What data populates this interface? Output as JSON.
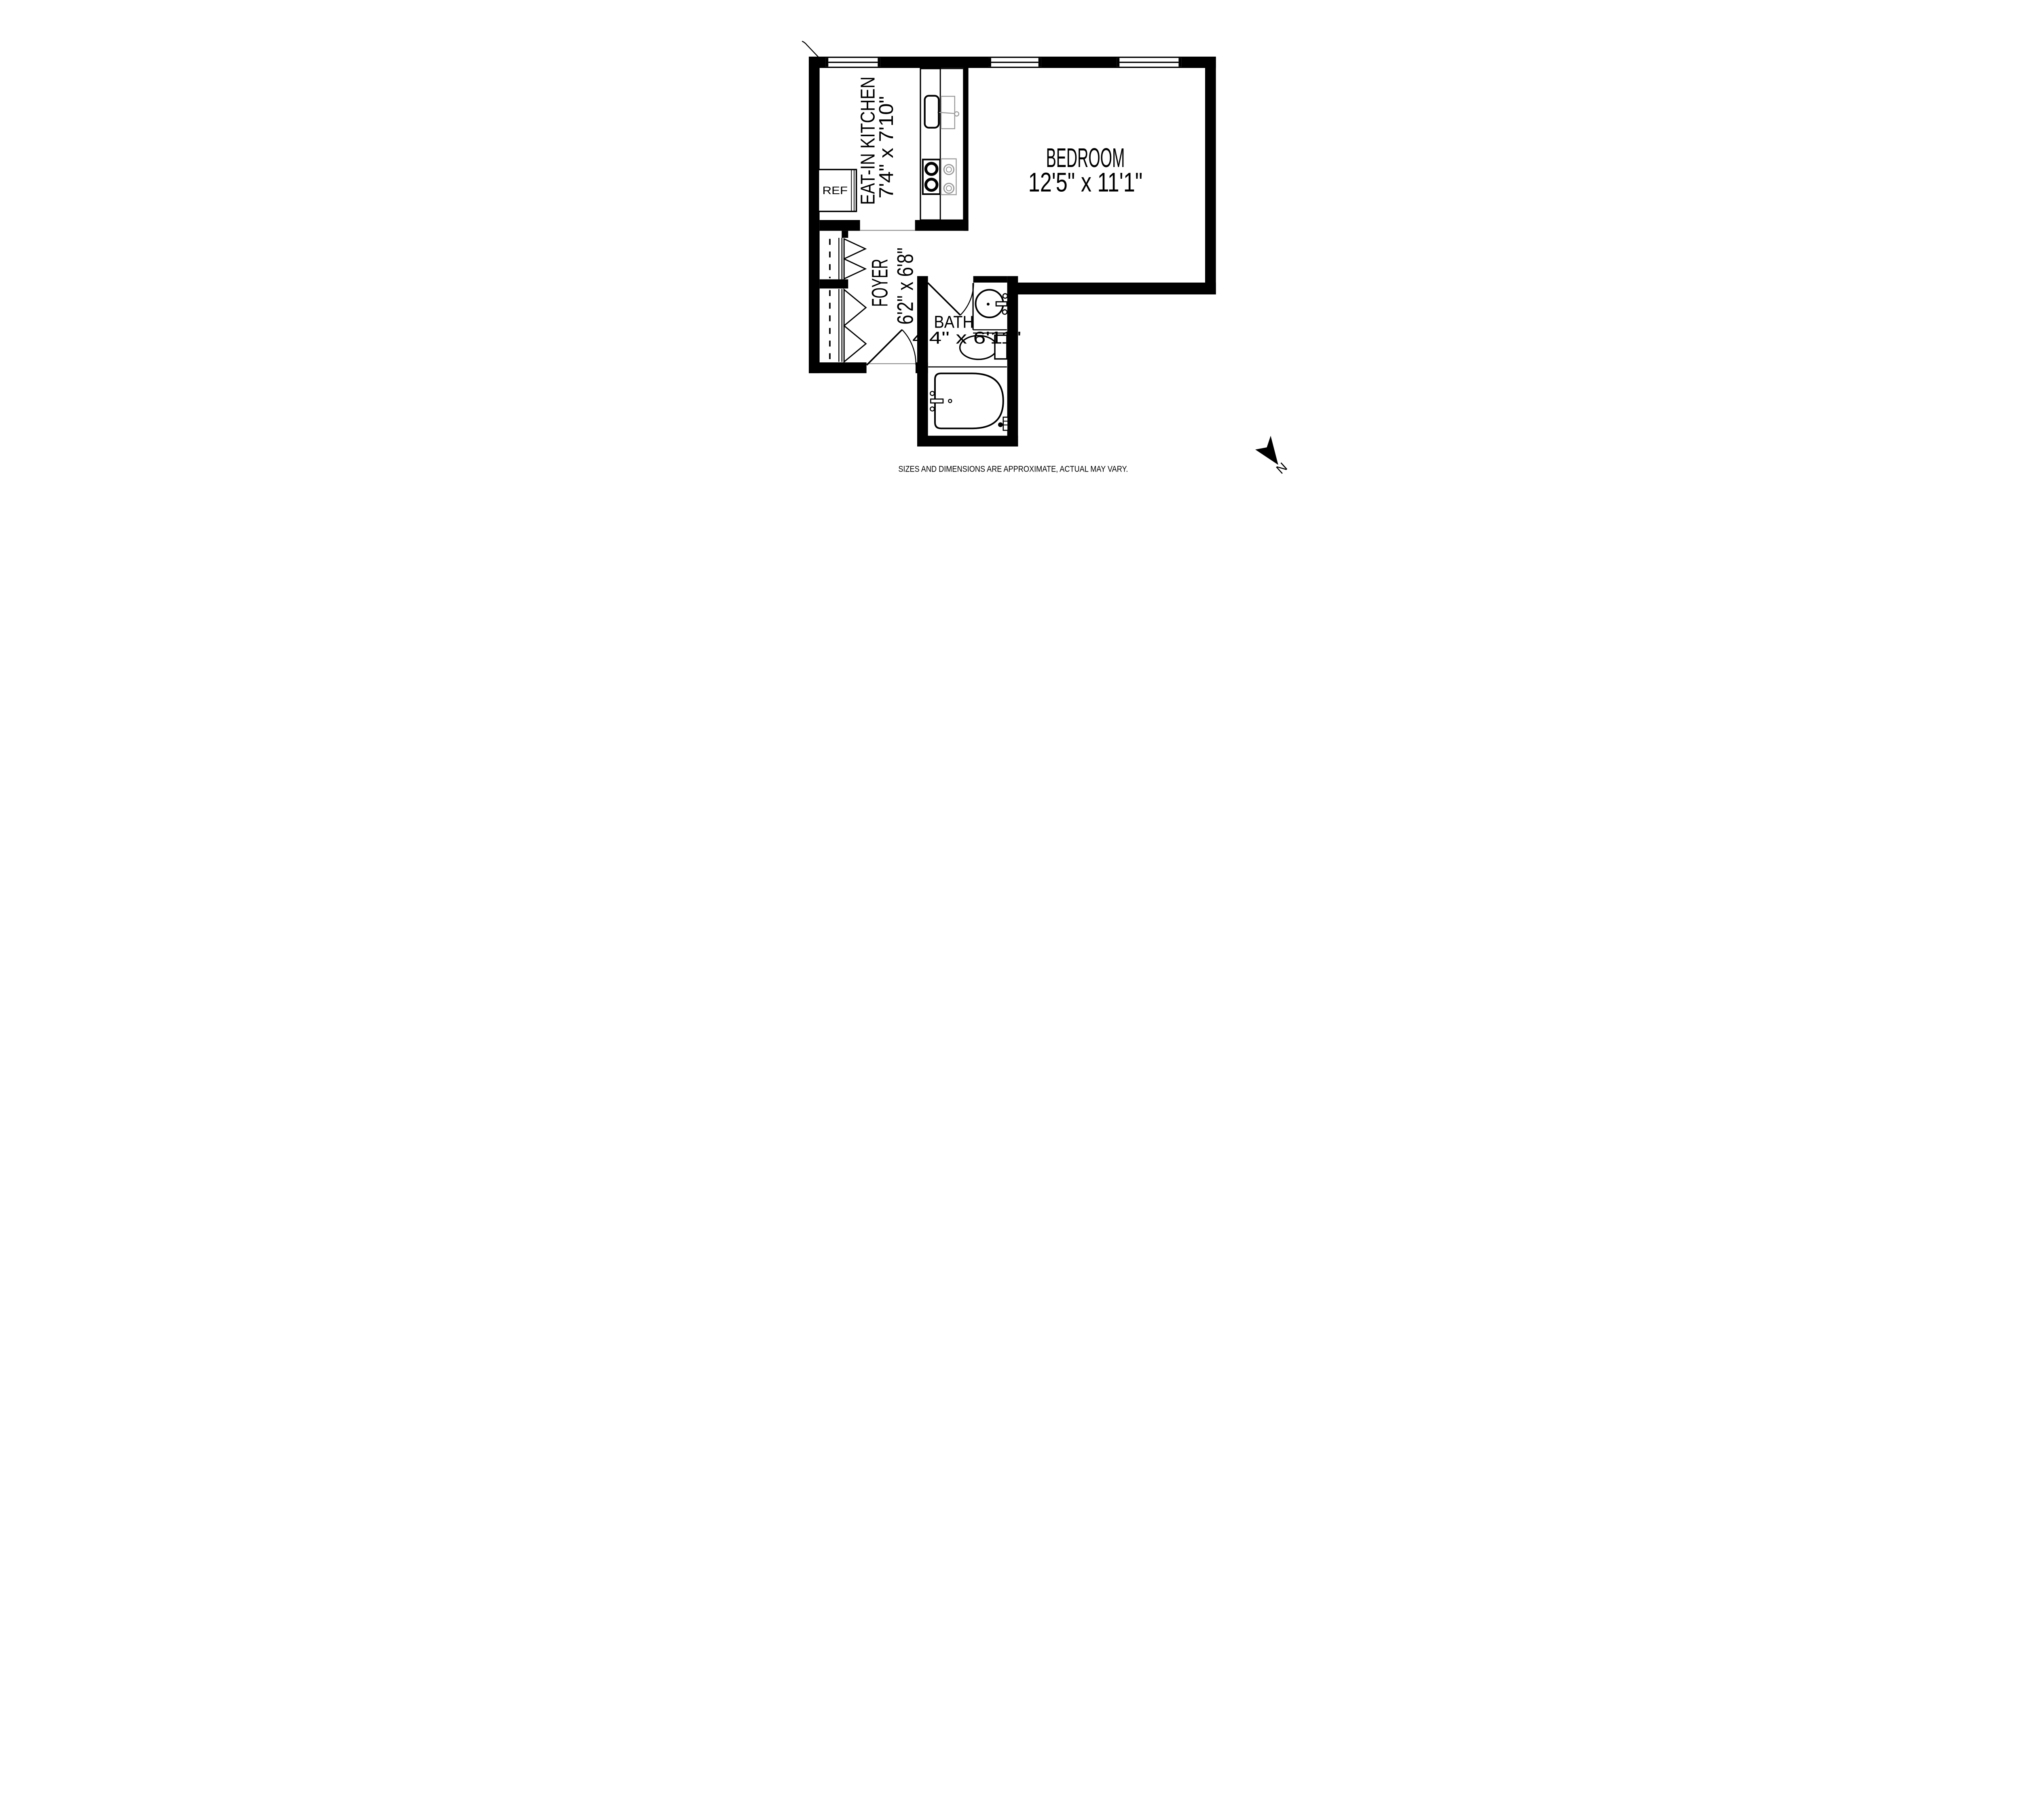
{
  "floorplan": {
    "rooms": [
      {
        "id": "kitchen",
        "name": "EAT-IN KITCHEN",
        "dimensions": "7'4\" x 7'10\""
      },
      {
        "id": "bedroom",
        "name": "BEDROOM",
        "dimensions": "12'5\" x 11'1\""
      },
      {
        "id": "foyer",
        "name": "FOYER",
        "dimensions": "6'2\" x 6'8\""
      },
      {
        "id": "bath",
        "name": "BATH",
        "dimensions": "4'4\" x 6'11\""
      }
    ],
    "appliances": {
      "refrigerator_label": "REF"
    },
    "compass": {
      "north_label": "N"
    },
    "disclaimer": "SIZES AND DIMENSIONS ARE APPROXIMATE, ACTUAL MAY VARY.",
    "colors": {
      "walls": "#000000",
      "fixture_gray": "#9a9a9a",
      "disclaimer_text": "#a0a0a0",
      "background": "#ffffff"
    }
  }
}
